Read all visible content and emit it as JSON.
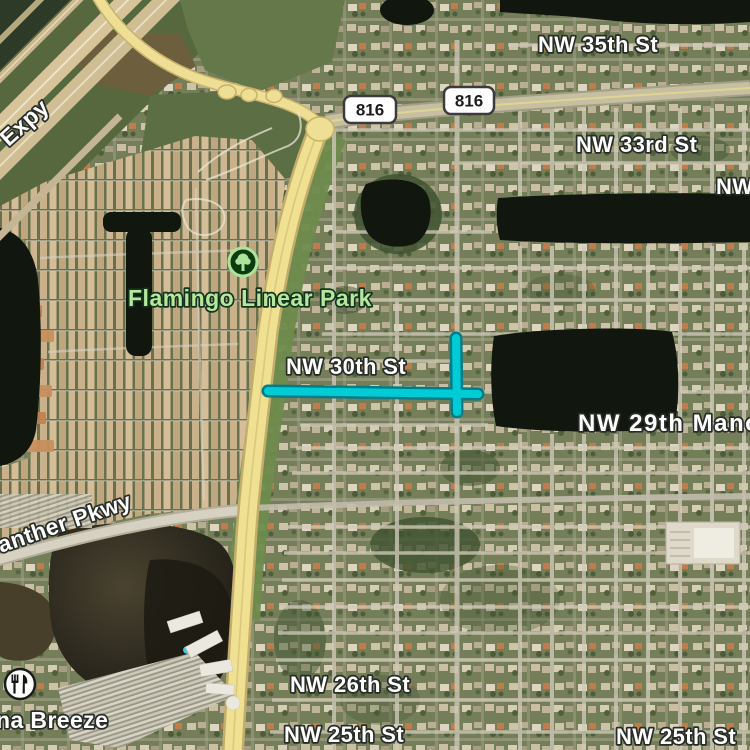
{
  "map": {
    "view": "satellite",
    "colors": {
      "route_highlight": "#00ccd6",
      "route_casing": "#007d89",
      "main_road_yellow": "#efe092",
      "park_label_green": "#b5e79e",
      "water_dark": "#11160e",
      "lake_brown": "#473f2a",
      "shield_background": "#ffffff"
    }
  },
  "labels": {
    "expressway_partial": "Expy",
    "shield_816_left": "816",
    "shield_816_right": "816",
    "nw_35th_st": "NW 35th St",
    "nw_33rd_st": "NW 33rd St",
    "nw_edge_partial": "NW",
    "flamingo_linear_park": "Flamingo Linear Park",
    "nw_30th_st": "NW 30th St",
    "nw_29th_manor": "NW 29th Manor",
    "panther_pkwy": "Panther Pkwy",
    "nw_26th_st": "NW 26th St",
    "nw_25th_st_left": "NW 25th St",
    "nw_25th_st_right": "NW 25th St",
    "breeze_partial": "na Breeze"
  },
  "icons": {
    "park": "tree-icon",
    "restaurant": "fork-knife-icon"
  }
}
